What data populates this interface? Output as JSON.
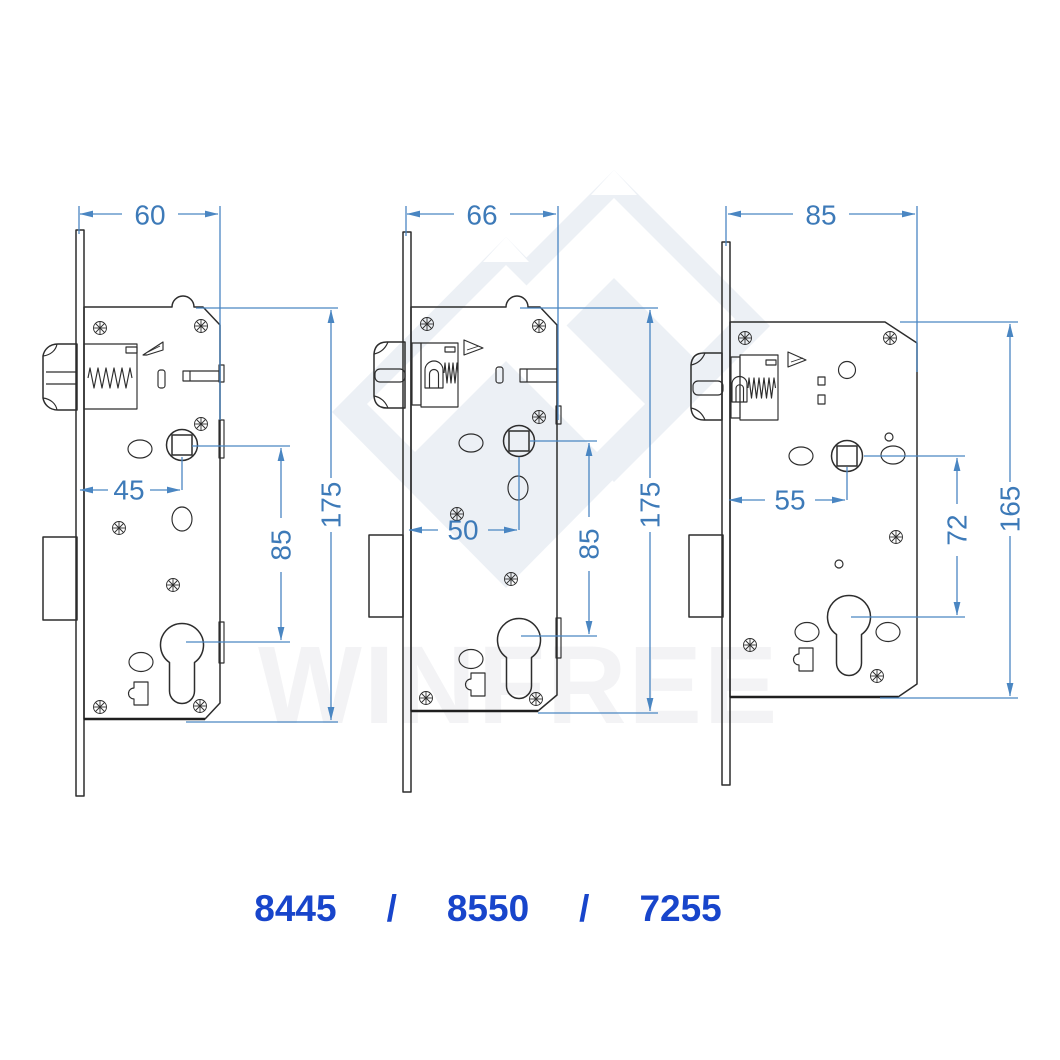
{
  "watermark": {
    "text": "WINFREE"
  },
  "drawing": {
    "description": "three mortise lock bodies with dimensions in mm",
    "locks": [
      {
        "model": "8445",
        "labels": {
          "width": "60",
          "height": "175",
          "backset": "45",
          "centers": "85"
        }
      },
      {
        "model": "8550",
        "labels": {
          "width": "66",
          "height": "175",
          "backset": "50",
          "centers": "85"
        }
      },
      {
        "model": "7255",
        "labels": {
          "width": "85",
          "height": "165",
          "backset": "55",
          "centers": "72"
        }
      }
    ]
  },
  "footer": {
    "models": [
      "8445",
      "8550",
      "7255"
    ],
    "separator": "/"
  },
  "colors": {
    "dimension_line": "#4a86c2",
    "dimension_text": "#3d7ab8",
    "model_text": "#1845cb",
    "drawing_line": "#2d2d2d",
    "watermark_fill": "#ecf0f5"
  }
}
